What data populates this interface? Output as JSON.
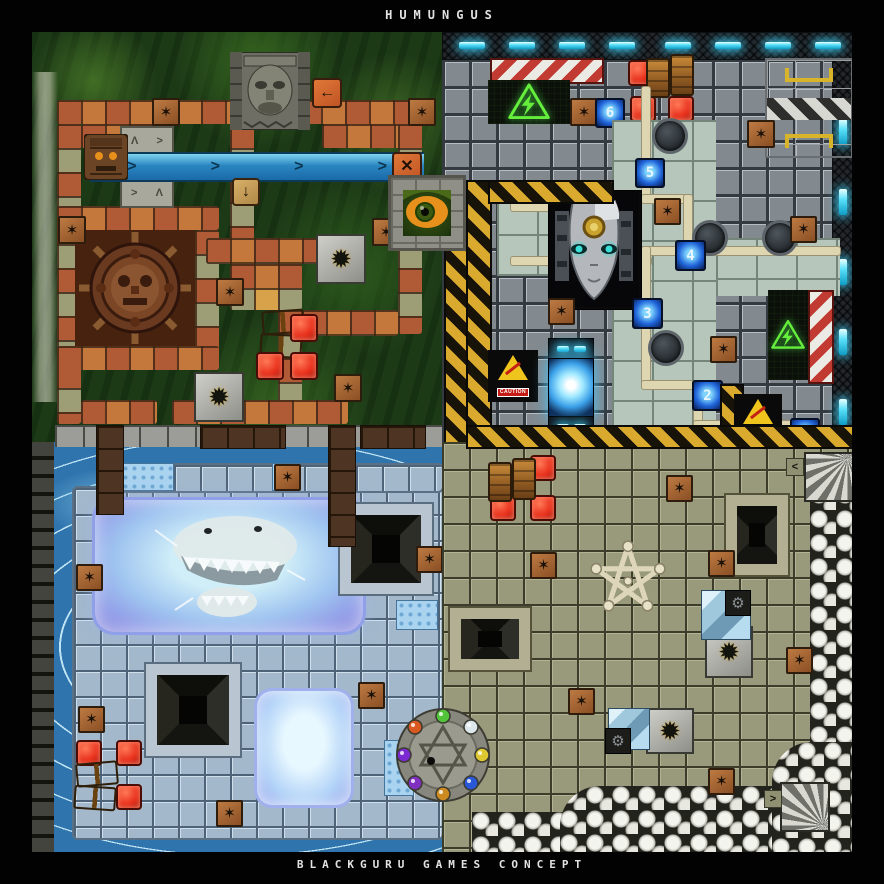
{
  "header": {
    "title": "HUMUNGUS"
  },
  "footer": {
    "text": "BLACKGURU GAMES CONCEPT"
  },
  "tech": {
    "waypoints": [
      "6",
      "5",
      "4",
      "3",
      "2",
      "1"
    ],
    "caution_label": "CAUTION"
  },
  "icons": {
    "arrow_left": "←",
    "arrow_down": "↓",
    "arrow_right": ">",
    "arrow_left_small": "<",
    "arrow_right_small": ">",
    "cross": "✕",
    "spike_star": "✶",
    "spike_burst": "✹",
    "lightning": "⚡",
    "gear": "⚙",
    "rune_a": "Λ",
    "rune_b": ">"
  },
  "colors": {
    "background": "#000000",
    "jungle_tile_orange": "#c5783c",
    "jungle_tile_tan": "#d8a24a",
    "metal_tile_grey": "#82898f",
    "panel_green": "#b6c6ba",
    "ice_tile_blue": "#a3b8cb",
    "bone_tile_olive": "#99997b",
    "water_blue": "#2f74ad",
    "hazard_yellow": "#d9aa2e",
    "danger_red": "#e8301c",
    "waypoint_blue": "#1e62d8",
    "energy_cyan": "#3ecdf2",
    "sign_green": "#66ee3c",
    "caution_yellow": "#efc41c"
  }
}
